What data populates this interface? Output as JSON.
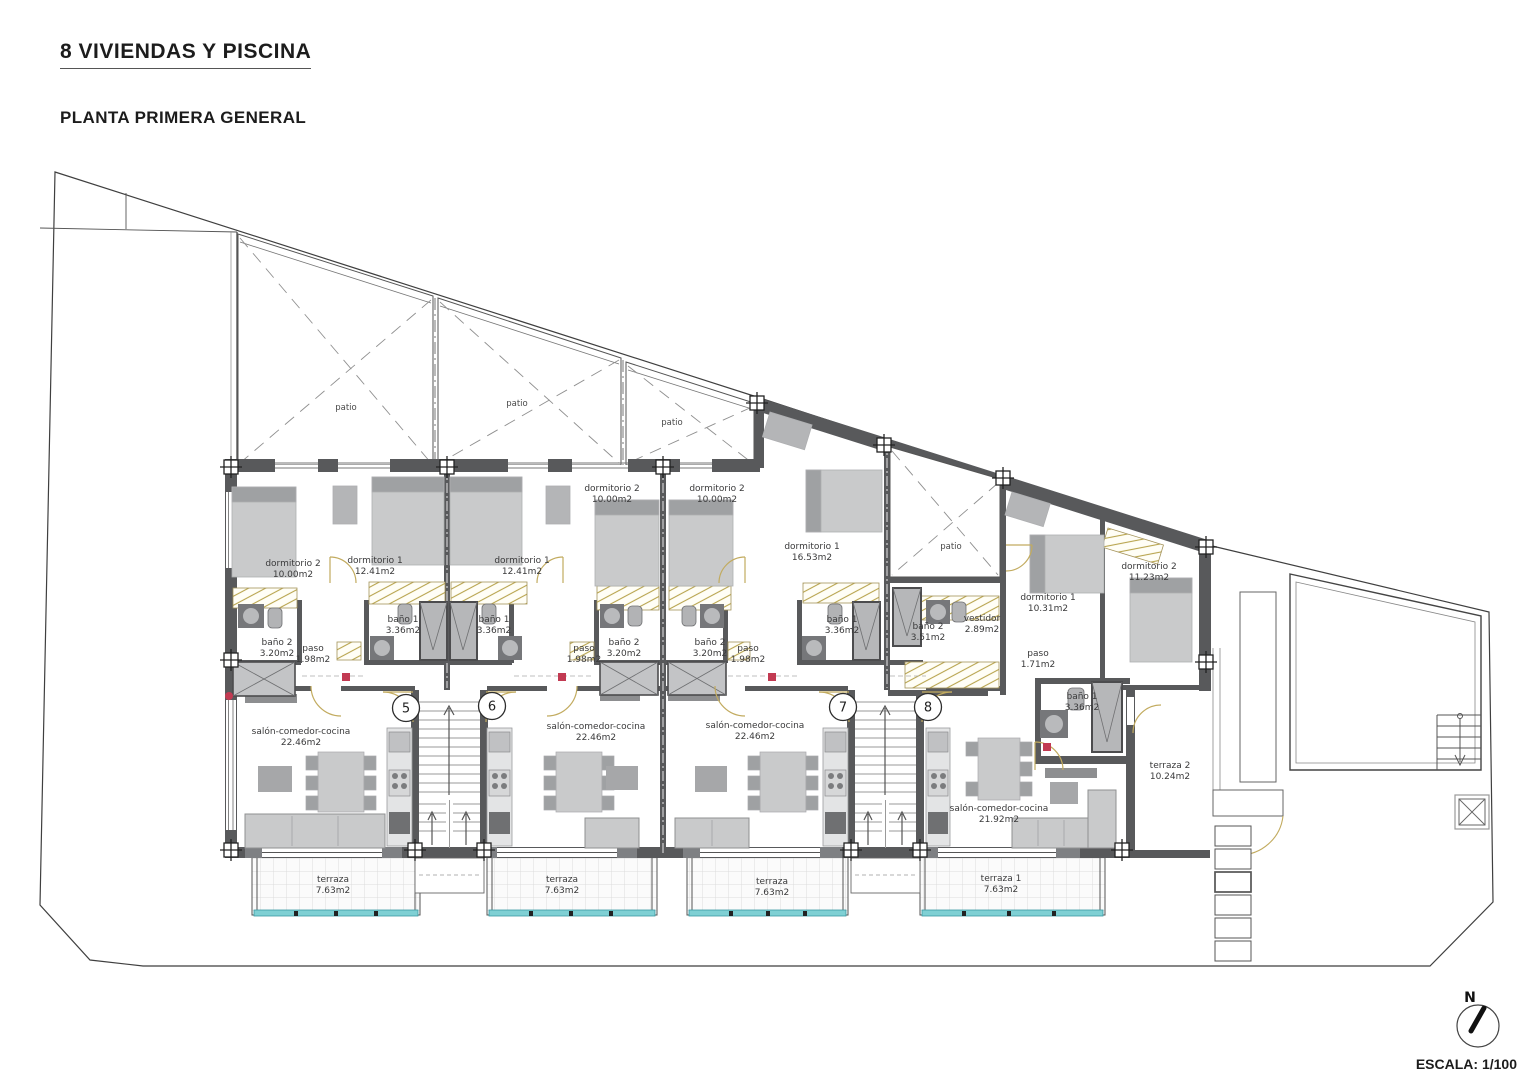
{
  "header": {
    "title": "8 VIVIENDAS Y PISCINA",
    "subtitle": "PLANTA PRIMERA GENERAL"
  },
  "footer": {
    "scale_label": "ESCALA: 1/100",
    "compass_north": "N"
  },
  "colors": {
    "wall": "#58595b",
    "wall_light": "#7e8083",
    "hatch_line": "#b8a44e",
    "door_arc": "#c2ab5f",
    "glass_teal": "#7fd0d4",
    "teal_edge": "#3a9aa3",
    "accent_red": "#c23a52",
    "furniture": "#c9cacb",
    "furniture_dark": "#9fa1a3",
    "grid_line": "#dcdcdc",
    "line": "#3f3f3f",
    "text": "#3a3a3b"
  },
  "plan": {
    "patios": [
      {
        "label": "patio",
        "x": 346,
        "y": 410
      },
      {
        "label": "patio",
        "x": 517,
        "y": 406
      },
      {
        "label": "patio",
        "x": 672,
        "y": 425
      },
      {
        "label": "patio",
        "x": 951,
        "y": 549
      }
    ],
    "units": [
      {
        "number": "5",
        "badge": {
          "x": 406,
          "y": 708
        },
        "rooms": [
          {
            "label": "dormitorio 2",
            "area": "10.00m2",
            "x": 293,
            "y": 566
          },
          {
            "label": "dormitorio 1",
            "area": "12.41m2",
            "x": 375,
            "y": 563
          },
          {
            "label": "baño 1",
            "area": "3.36m2",
            "x": 403,
            "y": 622
          },
          {
            "label": "baño 2",
            "area": "3.20m2",
            "x": 277,
            "y": 645
          },
          {
            "label": "paso",
            "area": "1.98m2",
            "x": 313,
            "y": 651
          },
          {
            "label": "salón-comedor-cocina",
            "area": "22.46m2",
            "x": 301,
            "y": 734
          },
          {
            "label": "terraza",
            "area": "7.63m2",
            "x": 333,
            "y": 882
          }
        ]
      },
      {
        "number": "6",
        "badge": {
          "x": 492,
          "y": 706
        },
        "rooms": [
          {
            "label": "dormitorio 1",
            "area": "12.41m2",
            "x": 522,
            "y": 563
          },
          {
            "label": "dormitorio 2",
            "area": "10.00m2",
            "x": 612,
            "y": 491
          },
          {
            "label": "baño 1",
            "area": "3.36m2",
            "x": 494,
            "y": 622
          },
          {
            "label": "baño 2",
            "area": "3.20m2",
            "x": 624,
            "y": 645
          },
          {
            "label": "paso",
            "area": "1.98m2",
            "x": 584,
            "y": 651
          },
          {
            "label": "salón-comedor-cocina",
            "area": "22.46m2",
            "x": 596,
            "y": 729
          },
          {
            "label": "terraza",
            "area": "7.63m2",
            "x": 562,
            "y": 882
          }
        ]
      },
      {
        "number": "7",
        "badge": {
          "x": 843,
          "y": 707
        },
        "rooms": [
          {
            "label": "dormitorio 2",
            "area": "10.00m2",
            "x": 717,
            "y": 491
          },
          {
            "label": "dormitorio 1",
            "area": "16.53m2",
            "x": 812,
            "y": 549
          },
          {
            "label": "baño 2",
            "area": "3.20m2",
            "x": 710,
            "y": 645
          },
          {
            "label": "paso",
            "area": "1.98m2",
            "x": 748,
            "y": 651
          },
          {
            "label": "baño 1",
            "area": "3.36m2",
            "x": 842,
            "y": 622
          },
          {
            "label": "salón-comedor-cocina",
            "area": "22.46m2",
            "x": 755,
            "y": 728
          },
          {
            "label": "terraza",
            "area": "7.63m2",
            "x": 772,
            "y": 884
          }
        ]
      },
      {
        "number": "8",
        "badge": {
          "x": 928,
          "y": 707
        },
        "rooms": [
          {
            "label": "baño 2",
            "area": "3.51m2",
            "x": 928,
            "y": 629
          },
          {
            "label": "vestidor",
            "area": "2.89m2",
            "x": 982,
            "y": 621
          },
          {
            "label": "dormitorio 1",
            "area": "10.31m2",
            "x": 1048,
            "y": 600
          },
          {
            "label": "dormitorio 2",
            "area": "11.23m2",
            "x": 1149,
            "y": 569
          },
          {
            "label": "paso",
            "area": "1.71m2",
            "x": 1038,
            "y": 656
          },
          {
            "label": "baño 1",
            "area": "3.36m2",
            "x": 1082,
            "y": 699
          },
          {
            "label": "salón-comedor-cocina",
            "area": "21.92m2",
            "x": 999,
            "y": 811
          },
          {
            "label": "terraza 1",
            "area": "7.63m2",
            "x": 1001,
            "y": 881
          },
          {
            "label": "terraza 2",
            "area": "10.24m2",
            "x": 1170,
            "y": 768
          }
        ]
      }
    ]
  }
}
